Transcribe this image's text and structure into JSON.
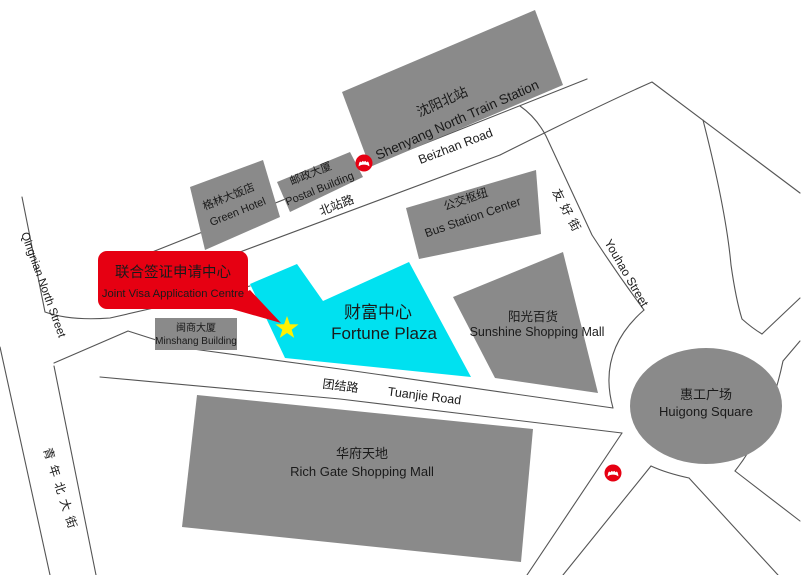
{
  "colors": {
    "background": "#FFFFFF",
    "building_gray": "#8A8A8A",
    "fortune_cyan": "#00E1F0",
    "marker_red": "#E60012",
    "star_yellow": "#FFF100",
    "road_line": "#555555",
    "text_black": "#1A1A1A",
    "station_zh_text": "#9C9C9C",
    "callout_text": "#FFFFFF"
  },
  "callout": {
    "line1": "联合签证申请中心",
    "line2": "Joint Visa Application Centre"
  },
  "buildings": {
    "station": {
      "zh": "沈阳北站",
      "en": "Shenyang North Train Station"
    },
    "green_hotel": {
      "zh": "格林大饭店",
      "en": "Green Hotel"
    },
    "postal": {
      "zh": "邮政大厦",
      "en": "Postal Building"
    },
    "bus_station": {
      "zh": "公交枢纽",
      "en": "Bus Station Center"
    },
    "fortune_plaza": {
      "zh": "财富中心",
      "en": "Fortune Plaza"
    },
    "sunshine": {
      "zh": "阳光百货",
      "en": "Sunshine Shopping Mall"
    },
    "minshang": {
      "zh": "闽商大厦",
      "en": "Minshang Building"
    },
    "rich_gate": {
      "zh": "华府天地",
      "en": "Rich Gate Shopping Mall"
    },
    "huigong": {
      "zh": "惠工广场",
      "en": "Huigong Square"
    }
  },
  "roads": {
    "beizhan": {
      "zh": "北站路",
      "en": "Beizhan Road"
    },
    "tuanjie": {
      "zh": "团结路",
      "en": "Tuanjie Road"
    },
    "youhao": {
      "zh": "友好街",
      "en": "Youhao Street"
    },
    "qingnian": {
      "zh": "青年北大街",
      "en": "Qingnian North Street"
    }
  },
  "icons": {
    "metro": "shenyang-metro-logo",
    "location_marker": "yellow-star"
  }
}
